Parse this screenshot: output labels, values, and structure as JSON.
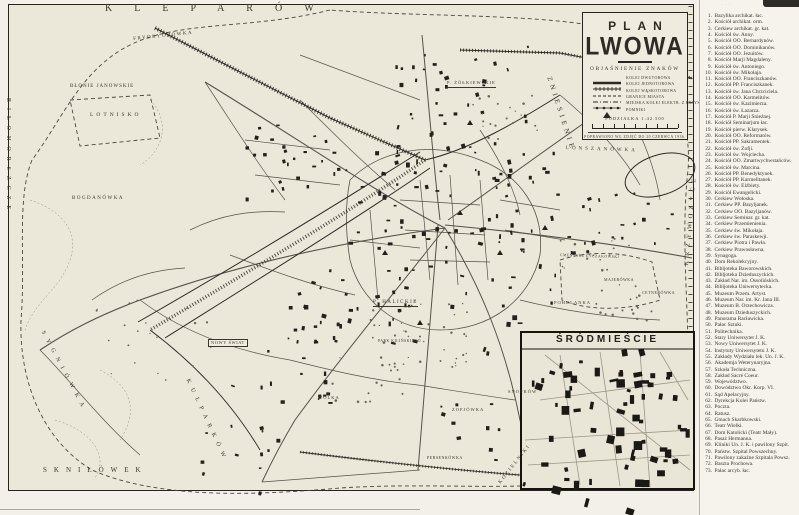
{
  "title": {
    "line1": "PLAN",
    "line2": "LWOWA"
  },
  "legend": {
    "heading": "OBJAŚNIENIE ZNAKÓW",
    "items": [
      {
        "symbol": "double-track-line",
        "label": "KOLEJ DWUTOROWA"
      },
      {
        "symbol": "single-track-line",
        "label": "KOLEJ JEDNOTOROWA"
      },
      {
        "symbol": "narrow-gauge-line",
        "label": "KOLEJ WĄSKOTOROWA"
      },
      {
        "symbol": "city-border-line",
        "label": "GRANICE MIASTA"
      },
      {
        "symbol": "tram-line",
        "label": "MIEJSKA KOLEJ ELEKTR. Z PRZYSTANK."
      },
      {
        "symbol": "monument-triangle",
        "label": "POMNIKI"
      }
    ],
    "scale_label": "PODZIAŁKA 1:42.500",
    "note": "POPRAWIONO WG ZDJĘĆ DO 20 CZERWCA 1936."
  },
  "inset": {
    "title": "ŚRÓDMIEŚCIE"
  },
  "map": {
    "labels": [
      {
        "text": "KLEPARÓW",
        "x": 105,
        "y": 4,
        "fs": 10,
        "ls": 22,
        "rot": 0
      },
      {
        "text": "FRYDRYCHÓWKA",
        "x": 133,
        "y": 37,
        "fs": 5,
        "ls": 1.5,
        "rot": -6
      },
      {
        "text": "BŁONIE JANOWSKIE",
        "x": 70,
        "y": 84,
        "fs": 5,
        "ls": 1,
        "rot": 0
      },
      {
        "text": "LOTNISKO",
        "x": 90,
        "y": 113,
        "fs": 5.5,
        "ls": 3,
        "rot": 0
      },
      {
        "text": "BIŁOHORSZCZE",
        "x": 11,
        "y": 98,
        "fs": 6,
        "ls": 6,
        "rot": 90
      },
      {
        "text": "BOGDANÓWKA",
        "x": 72,
        "y": 196,
        "fs": 5,
        "ls": 1.5,
        "rot": 0
      },
      {
        "text": "SYGNIÓWKA",
        "x": 45,
        "y": 330,
        "fs": 6,
        "ls": 6,
        "rot": 62
      },
      {
        "text": "SKNIŁÓWEK",
        "x": 43,
        "y": 467,
        "fs": 7,
        "ls": 7,
        "rot": 0
      },
      {
        "text": "KULPARKÓW",
        "x": 190,
        "y": 378,
        "fs": 6,
        "ls": 6,
        "rot": 65
      },
      {
        "text": "NOWY ŚWIAT",
        "x": 208,
        "y": 339,
        "fs": 4.5,
        "ls": 0.5,
        "rot": 0,
        "boxed": true
      },
      {
        "text": "WÓLKA",
        "x": 318,
        "y": 396,
        "fs": 4.5,
        "ls": 1,
        "rot": 0
      },
      {
        "text": "ZOFJÓWKA",
        "x": 452,
        "y": 408,
        "fs": 4.5,
        "ls": 1,
        "rot": 0
      },
      {
        "text": "SNOPKÓW",
        "x": 508,
        "y": 390,
        "fs": 4.5,
        "ls": 1,
        "rot": 0
      },
      {
        "text": "PERSENKÓWKA",
        "x": 427,
        "y": 456,
        "fs": 4,
        "ls": 0.5,
        "rot": 0
      },
      {
        "text": "KOZIELNIKI",
        "x": 498,
        "y": 482,
        "fs": 5,
        "ls": 2,
        "rot": -52
      },
      {
        "text": "POHULANKA",
        "x": 554,
        "y": 301,
        "fs": 4.5,
        "ls": 1,
        "rot": 0
      },
      {
        "text": "MAJERÓWKA",
        "x": 604,
        "y": 278,
        "fs": 4,
        "ls": 0.5,
        "rot": 0
      },
      {
        "text": "CETNERÓWKA",
        "x": 642,
        "y": 291,
        "fs": 4,
        "ls": 0.5,
        "rot": 0
      },
      {
        "text": "CMENTARZ ŁYCZAKOWSKI",
        "x": 560,
        "y": 254,
        "fs": 3.8,
        "ls": 0.5,
        "rot": 2
      },
      {
        "text": "ZNIESIENIE",
        "x": 552,
        "y": 76,
        "fs": 7,
        "ls": 4,
        "rot": 72
      },
      {
        "text": "P. ŻÓŁKIEWSKIE",
        "x": 447,
        "y": 81,
        "fs": 4.5,
        "ls": 1,
        "rot": 0,
        "underline": true
      },
      {
        "text": "P. HALICKIE",
        "x": 373,
        "y": 300,
        "fs": 5,
        "ls": 1.5,
        "rot": 0,
        "underline": true
      },
      {
        "text": "PARK KILIŃSKIEGO",
        "x": 378,
        "y": 340,
        "fs": 3.8,
        "ls": 0.5,
        "rot": 0
      },
      {
        "text": "LONSZANÓWKA",
        "x": 566,
        "y": 146,
        "fs": 5,
        "ls": 3,
        "rot": 2
      },
      {
        "text": "KRZYWCZYCE",
        "x": 684,
        "y": 265,
        "fs": 6,
        "ls": 5,
        "rot": -85
      }
    ]
  },
  "index": {
    "entries": [
      {
        "n": "1.",
        "label": "Bazylika archikat. łac."
      },
      {
        "n": "2.",
        "label": "Kościół archikat. orm."
      },
      {
        "n": "3.",
        "label": "Cerkiew archikat. gr. kat."
      },
      {
        "n": "4.",
        "label": "Kościół św. Anny."
      },
      {
        "n": "5.",
        "label": "Kościół OO. Bernardynów."
      },
      {
        "n": "6.",
        "label": "Kościół OO. Dominikanów."
      },
      {
        "n": "7.",
        "label": "Kościół OO. Jezuitów."
      },
      {
        "n": "8.",
        "label": "Kościół Marji Magdaleny."
      },
      {
        "n": "9.",
        "label": "Kościół św. Antoniego."
      },
      {
        "n": "10.",
        "label": "Kościół św. Mikołaja."
      },
      {
        "n": "11.",
        "label": "Kościół OO. Franciszkanów."
      },
      {
        "n": "12.",
        "label": "Kościół PP. Franciszkanek."
      },
      {
        "n": "13.",
        "label": "Kościół św. Jana Chrzciciela."
      },
      {
        "n": "14.",
        "label": "Kościół OO. Karmelitów."
      },
      {
        "n": "15.",
        "label": "Kościół św. Kazimierza."
      },
      {
        "n": "16.",
        "label": "Kościół św. Łazarza."
      },
      {
        "n": "17.",
        "label": "Kościół P. Marji Śnieżnej."
      },
      {
        "n": "18.",
        "label": "Kościół Seminarjum łac."
      },
      {
        "n": "19.",
        "label": "Kościół pierw. Klarysek."
      },
      {
        "n": "20.",
        "label": "Kościół OO. Reformatów."
      },
      {
        "n": "21.",
        "label": "Kościół PP. Sakramentek."
      },
      {
        "n": "22.",
        "label": "Kościół św. Zofji."
      },
      {
        "n": "23.",
        "label": "Kościół św. Wojciecha."
      },
      {
        "n": "24.",
        "label": "Kościół OO. Zmartwychwstańców."
      },
      {
        "n": "25.",
        "label": "Kościół św. Marcina."
      },
      {
        "n": "26.",
        "label": "Kościół PP. Benedyktynek."
      },
      {
        "n": "27.",
        "label": "Kościół PP. Karmelitanek."
      },
      {
        "n": "28.",
        "label": "Kościół św. Elżbiety."
      },
      {
        "n": "29.",
        "label": "Kościół Ewangelicki."
      },
      {
        "n": "30.",
        "label": "Cerkiew Wołoska."
      },
      {
        "n": "31.",
        "label": "Cerkiew PP. Bazyljanek."
      },
      {
        "n": "32.",
        "label": "Cerkiew OO. Bazyljanów."
      },
      {
        "n": "33.",
        "label": "Cerkiew Seminar. gr. kat."
      },
      {
        "n": "34.",
        "label": "Cerkiew Przemienienia."
      },
      {
        "n": "35.",
        "label": "Cerkiew św. Mikołaja."
      },
      {
        "n": "36.",
        "label": "Cerkiew św. Paraskewji."
      },
      {
        "n": "37.",
        "label": "Cerkiew Piotra i Pawła."
      },
      {
        "n": "38.",
        "label": "Cerkiew Prawosławna."
      },
      {
        "n": "39.",
        "label": "Synagoga."
      },
      {
        "n": "40.",
        "label": "Dom Rekolekcyjny."
      },
      {
        "n": "41.",
        "label": "Bibljoteka Baworowskich."
      },
      {
        "n": "42.",
        "label": "Bibljoteka Dzieduszyckich."
      },
      {
        "n": "43.",
        "label": "Zakład Nar. im. Ossolińskich."
      },
      {
        "n": "44.",
        "label": "Bibljoteka Uniwersytecka."
      },
      {
        "n": "45.",
        "label": "Muzeum Przem. Artyst."
      },
      {
        "n": "46.",
        "label": "Muzeum Nar. im. Kr. Jana III."
      },
      {
        "n": "47.",
        "label": "Muzeum B. Orzechowicza."
      },
      {
        "n": "48.",
        "label": "Muzeum Dzieduszyckich."
      },
      {
        "n": "49.",
        "label": "Panorama Racławicka."
      },
      {
        "n": "50.",
        "label": "Pałac Sztuki."
      },
      {
        "n": "51.",
        "label": "Politechnika."
      },
      {
        "n": "52.",
        "label": "Stary Uniwersytet J. K."
      },
      {
        "n": "53.",
        "label": "Nowy Uniwersytet J. K."
      },
      {
        "n": "54.",
        "label": "Instytuty Uniwersytetu J. K."
      },
      {
        "n": "55.",
        "label": "Zakłady Wydziału lek. Un. J. K."
      },
      {
        "n": "56.",
        "label": "Akademja Weterynaryjna."
      },
      {
        "n": "57.",
        "label": "Szkoła Techniczna."
      },
      {
        "n": "58.",
        "label": "Zakład Sacré Coeur."
      },
      {
        "n": "59.",
        "label": "Województwo."
      },
      {
        "n": "60.",
        "label": "Dowództwo Okr. Korp. VI."
      },
      {
        "n": "61.",
        "label": "Sąd Apelacyjny."
      },
      {
        "n": "62.",
        "label": "Dyrekcja Kolei Państw."
      },
      {
        "n": "63.",
        "label": "Poczta."
      },
      {
        "n": "64.",
        "label": "Ratusz."
      },
      {
        "n": "65.",
        "label": "Gmach Skarbkowski."
      },
      {
        "n": "66.",
        "label": "Teatr Wielki."
      },
      {
        "n": "67.",
        "label": "Dom Katolicki (Teatr Mały)."
      },
      {
        "n": "68.",
        "label": "Pasaż Hermanna."
      },
      {
        "n": "69.",
        "label": "Kliniki Un. J. K. i pawilony Szpit."
      },
      {
        "n": "70.",
        "label": "Państw. Szpital Powszechny."
      },
      {
        "n": "71.",
        "label": "Pawilony zakaźne Szpitala Powsz."
      },
      {
        "n": "72.",
        "label": "Baszta Prochowa."
      },
      {
        "n": "73.",
        "label": "Pałac arcyb. łac."
      }
    ]
  }
}
